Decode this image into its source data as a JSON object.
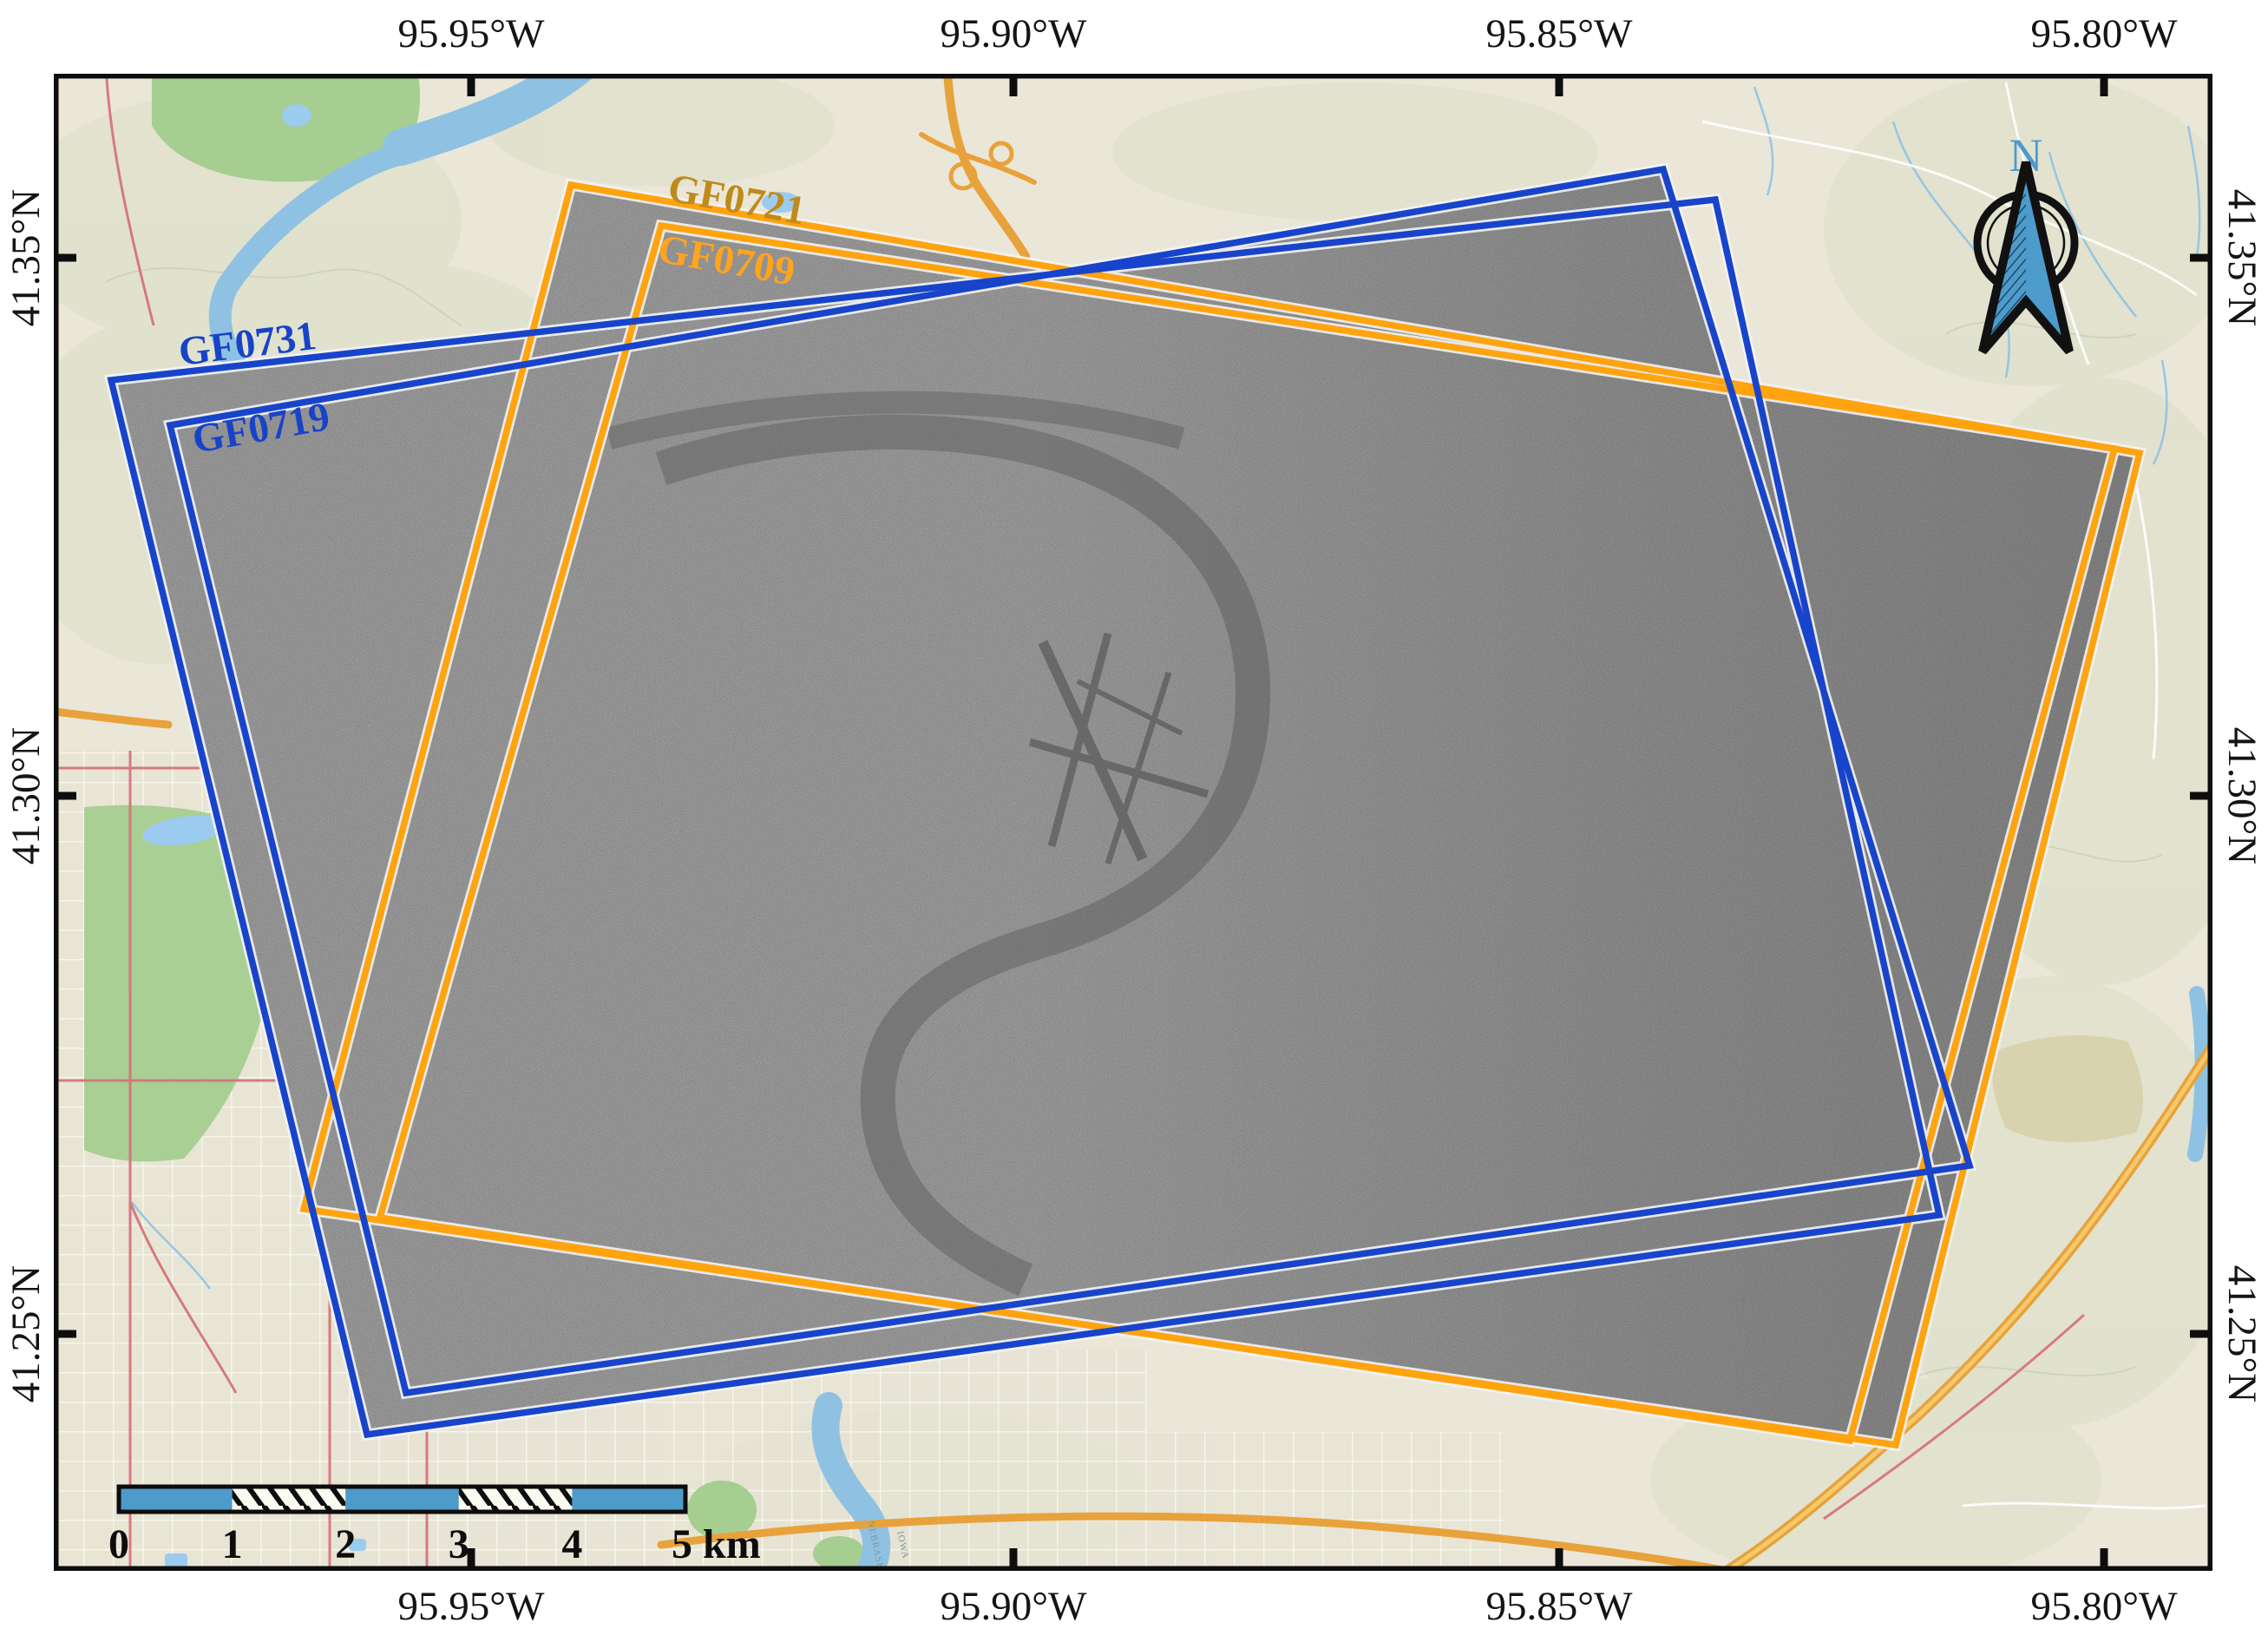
{
  "map": {
    "axis": {
      "top": [
        "95.95°W",
        "95.90°W",
        "95.85°W",
        "95.80°W"
      ],
      "bottom": [
        "95.95°W",
        "95.90°W",
        "95.85°W",
        "95.80°W"
      ],
      "left": [
        "41.35°N",
        "41.30°N",
        "41.25°N"
      ],
      "right": [
        "41.35°N",
        "41.30°N",
        "41.25°N"
      ]
    },
    "footprints": [
      {
        "id": "GF0721",
        "outline_color": "#FFA30E",
        "label_color": "#BE8A1C"
      },
      {
        "id": "GF0709",
        "outline_color": "#FFA30E",
        "label_color": "#FFA41C"
      },
      {
        "id": "GF0731",
        "outline_color": "#1844CB",
        "label_color": "#1743C9"
      },
      {
        "id": "GF0719",
        "outline_color": "#1844CB",
        "label_color": "#1743C9"
      }
    ],
    "scale_bar": {
      "tick_labels": [
        "0",
        "1",
        "2",
        "3",
        "4"
      ],
      "end_label": "5 km",
      "bar_color": "#4D9BCB"
    },
    "north_arrow": {
      "label": "N"
    },
    "annotations": {
      "river_left_bank": "NEBRASKA",
      "river_right_bank": "IOWA"
    }
  }
}
